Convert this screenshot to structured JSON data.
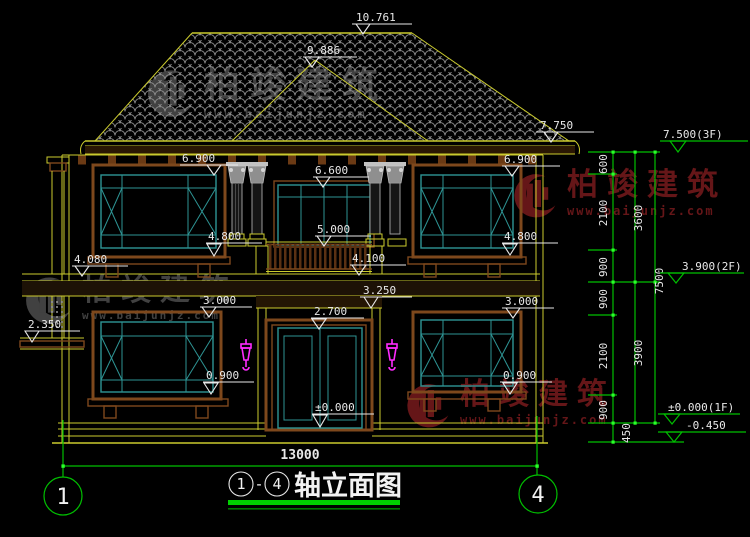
{
  "title": {
    "bubble_left": "1",
    "separator": "-",
    "bubble_right": "4",
    "text": "轴立面图"
  },
  "axis": {
    "left": "1",
    "right": "4"
  },
  "dims": {
    "overall_width": "13000"
  },
  "elev": {
    "ridge": "10.761",
    "sub_ridge": "9.886",
    "eave_right": "7.750",
    "wall_top_left": "6.900",
    "wall_top_right": "6.900",
    "balcony_door_head": "6.600",
    "railing_top": "5.000",
    "balcony_floor": "4.100",
    "band_top": "4.080",
    "sill_2f_left": "4.800",
    "sill_2f_right": "4.800",
    "porch_beam": "3.250",
    "win_head_1f_left": "3.000",
    "win_head_1f_right": "3.000",
    "door_head_1f": "2.700",
    "awning": "2.350",
    "sill_1f_left": "0.900",
    "sill_1f_right": "0.900",
    "ground_floor": "±0.000"
  },
  "chain": {
    "levels": {
      "f3": "7.500(3F)",
      "f2": "3.900(2F)",
      "f1": "±0.000(1F)",
      "ground": "-0.450"
    },
    "segments": [
      "600",
      "2100",
      "900",
      "900",
      "2100",
      "900",
      "450"
    ],
    "totals": [
      "3600",
      "3900",
      "7500"
    ]
  },
  "watermark": {
    "brand": "柏竣建筑",
    "url": "www.baijunjz.com"
  },
  "colors": {
    "line_yellow": "#cbcb2e",
    "frame_brown": "#7e481c",
    "glass_teal": "#2e9494",
    "dim_green": "#00bf00",
    "lamp_magenta": "#ff2bff",
    "text_white": "#e8e8e8",
    "watermark_red": "#6e181b",
    "watermark_gray": "#474747",
    "background": "#000000"
  }
}
